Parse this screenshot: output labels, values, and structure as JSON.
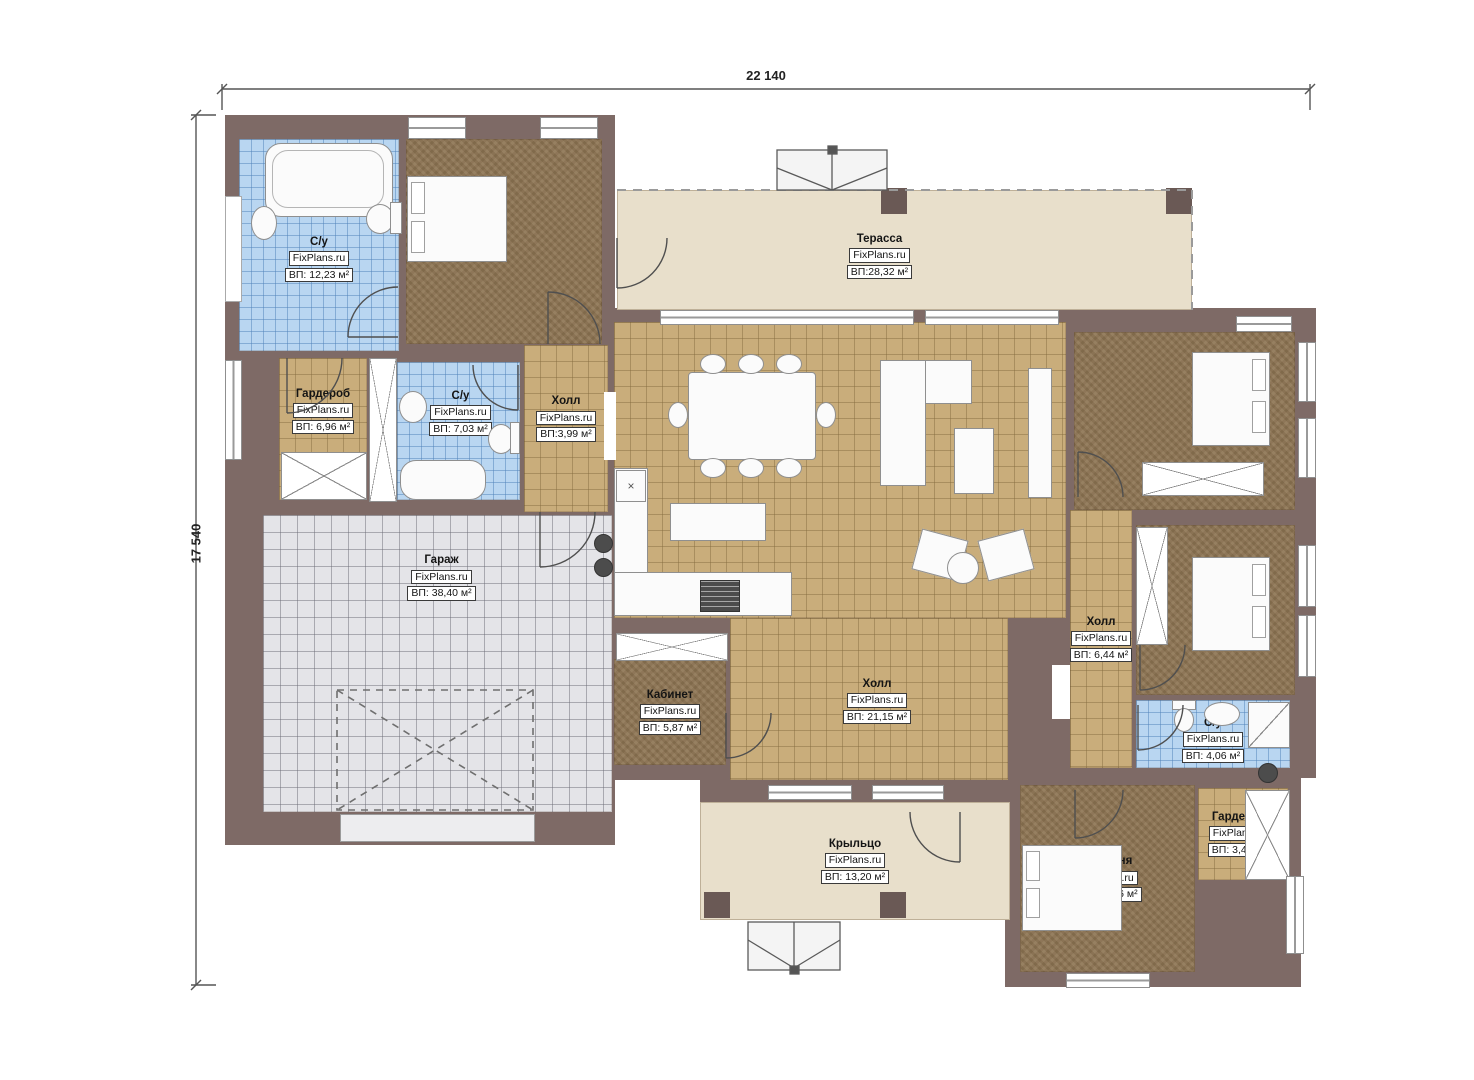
{
  "dimensions": {
    "top": "22 140",
    "left": "17 540"
  },
  "colors": {
    "wall": "#7e6a66",
    "column": "#6a5955",
    "tile": "#c9ad7b",
    "bath_tile": "#b9d6f1",
    "garage_floor": "#e4e4e8",
    "wood_floor": "#8d7452",
    "terrace_floor": "#e8dfcb"
  },
  "symbols": {
    "kitchen_unit": "×"
  },
  "rooms": [
    {
      "name": "С/у",
      "brand": "FixPlans.ru",
      "area": "ВП: 12,23 м²"
    },
    {
      "name": "Спальня",
      "brand": "FixPlans.ru",
      "area": "ВП: 16,65 м²"
    },
    {
      "name": "Гардероб",
      "brand": "FixPlans.ru",
      "area": "ВП: 6,96 м²"
    },
    {
      "name": "С/у",
      "brand": "FixPlans.ru",
      "area": "ВП: 7,03 м²"
    },
    {
      "name": "Холл",
      "brand": "FixPlans.ru",
      "area": "ВП:3,99 м²"
    },
    {
      "name": "Гараж",
      "brand": "FixPlans.ru",
      "area": "ВП: 38,40 м²"
    },
    {
      "name": "Терасса",
      "brand": "FixPlans.ru",
      "area": "ВП:28,32 м²"
    },
    {
      "name": "Гостиная-кухня",
      "brand": "FixPlans.ru",
      "area": "ВП: 52,53 м²"
    },
    {
      "name": "Спальня",
      "brand": "FixPlans.ru",
      "area": "ВП: 15,85 м²"
    },
    {
      "name": "Спальня",
      "brand": "FixPlans.ru",
      "area": "ВП: 12,80 м²"
    },
    {
      "name": "Холл",
      "brand": "FixPlans.ru",
      "area": "ВП: 6,44 м²"
    },
    {
      "name": "С/у",
      "brand": "FixPlans.ru",
      "area": "ВП: 4,06 м²"
    },
    {
      "name": "Кабинет",
      "brand": "FixPlans.ru",
      "area": "ВП: 5,87 м²"
    },
    {
      "name": "Холл",
      "brand": "FixPlans.ru",
      "area": "ВП: 21,15 м²"
    },
    {
      "name": "Крыльцо",
      "brand": "FixPlans.ru",
      "area": "ВП: 13,20 м²"
    },
    {
      "name": "Спальня",
      "brand": "FixPlans.ru",
      "area": "ВП: 12,36 м²"
    },
    {
      "name": "Гардероб",
      "brand": "FixPlans.ru",
      "area": "ВП: 3,46 м²"
    }
  ]
}
